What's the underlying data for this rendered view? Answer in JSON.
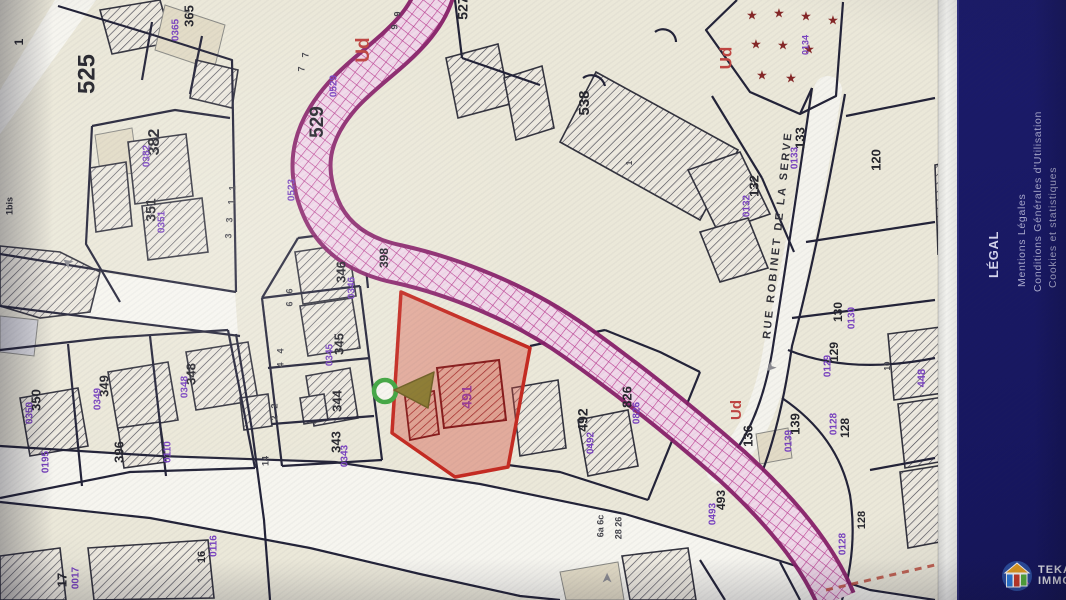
{
  "sidebar": {
    "heading": "LÉGAL",
    "links": [
      {
        "label": "Mentions Légales"
      },
      {
        "label": "Conditions Générales d'Utilisation"
      },
      {
        "label": "Cookies et statistiques"
      }
    ]
  },
  "watermark": {
    "line1": "TEKA",
    "line2": "IMMO"
  },
  "map": {
    "street_name": "RUE ROBINET DE LA SERVE",
    "selected_parcel_number": "491",
    "zone_code": "Ud",
    "star_glyph": "★",
    "arrow_glyph": "➤",
    "colors": {
      "background": "#ebe8d8",
      "road": "#f6f5ef",
      "parcel_line": "#23233a",
      "black_label": "#26262e",
      "purple_label": "#7b3fc8",
      "zone_label_red": "#c8433f",
      "selected_fill": "rgba(224,68,52,0.38)",
      "selected_stroke": "#d0281e",
      "band_magenta": "#8e1d6e",
      "star_red": "#8b2525",
      "sidebar_bg": "#191965"
    },
    "labels": [
      {
        "t": "525",
        "x": 88,
        "y": 74,
        "s": 24,
        "c": "k"
      },
      {
        "t": "1",
        "x": 20,
        "y": 42,
        "s": 12,
        "c": "k"
      },
      {
        "t": "365",
        "x": 190,
        "y": 16,
        "s": 13,
        "c": "k"
      },
      {
        "t": "0365",
        "x": 176,
        "y": 30,
        "s": 10,
        "c": "p"
      },
      {
        "t": "382",
        "x": 155,
        "y": 142,
        "s": 16,
        "c": "k"
      },
      {
        "t": "0382",
        "x": 147,
        "y": 156,
        "s": 10,
        "c": "p"
      },
      {
        "t": "351",
        "x": 152,
        "y": 210,
        "s": 14,
        "c": "k"
      },
      {
        "t": "0351",
        "x": 162,
        "y": 222,
        "s": 10,
        "c": "p"
      },
      {
        "t": "1bis",
        "x": 10,
        "y": 206,
        "s": 9,
        "c": "k"
      },
      {
        "t": "1",
        "x": 233,
        "y": 188,
        "s": 9,
        "c": "g"
      },
      {
        "t": "1",
        "x": 232,
        "y": 202,
        "s": 9,
        "c": "g"
      },
      {
        "t": "3",
        "x": 230,
        "y": 220,
        "s": 9,
        "c": "g"
      },
      {
        "t": "3",
        "x": 229,
        "y": 236,
        "s": 9,
        "c": "g"
      },
      {
        "t": "527",
        "x": 464,
        "y": 8,
        "s": 14,
        "c": "k"
      },
      {
        "t": "529",
        "x": 318,
        "y": 122,
        "s": 19,
        "c": "k"
      },
      {
        "t": "0529",
        "x": 334,
        "y": 86,
        "s": 10,
        "c": "p"
      },
      {
        "t": "Ud",
        "x": 364,
        "y": 50,
        "s": 19,
        "c": "r"
      },
      {
        "t": "7",
        "x": 306,
        "y": 55,
        "s": 9,
        "c": "g"
      },
      {
        "t": "7",
        "x": 302,
        "y": 69,
        "s": 9,
        "c": "g"
      },
      {
        "t": "9",
        "x": 398,
        "y": 14,
        "s": 9,
        "c": "g"
      },
      {
        "t": "9",
        "x": 395,
        "y": 27,
        "s": 9,
        "c": "g"
      },
      {
        "t": "398",
        "x": 385,
        "y": 258,
        "s": 12,
        "c": "k"
      },
      {
        "t": "0523",
        "x": 292,
        "y": 190,
        "s": 10,
        "c": "p"
      },
      {
        "t": "346",
        "x": 342,
        "y": 272,
        "s": 13,
        "c": "k"
      },
      {
        "t": "0346",
        "x": 352,
        "y": 288,
        "s": 10,
        "c": "p"
      },
      {
        "t": "538",
        "x": 585,
        "y": 103,
        "s": 15,
        "c": "k"
      },
      {
        "t": "1",
        "x": 630,
        "y": 163,
        "s": 8,
        "c": "g"
      },
      {
        "t": "Ud",
        "x": 727,
        "y": 58,
        "s": 17,
        "c": "r"
      },
      {
        "t": "0134",
        "x": 806,
        "y": 45,
        "s": 9,
        "c": "p"
      },
      {
        "t": "133",
        "x": 801,
        "y": 138,
        "s": 13,
        "c": "k"
      },
      {
        "t": "0133",
        "x": 795,
        "y": 158,
        "s": 10,
        "c": "p"
      },
      {
        "t": "132",
        "x": 755,
        "y": 186,
        "s": 13,
        "c": "k"
      },
      {
        "t": "0132",
        "x": 747,
        "y": 206,
        "s": 10,
        "c": "p"
      },
      {
        "t": "120",
        "x": 877,
        "y": 160,
        "s": 13,
        "c": "k"
      },
      {
        "t": "350",
        "x": 37,
        "y": 400,
        "s": 13,
        "c": "k"
      },
      {
        "t": "0350",
        "x": 30,
        "y": 413,
        "s": 10,
        "c": "p"
      },
      {
        "t": "349",
        "x": 105,
        "y": 386,
        "s": 13,
        "c": "k"
      },
      {
        "t": "0349",
        "x": 98,
        "y": 399,
        "s": 10,
        "c": "p"
      },
      {
        "t": "348",
        "x": 192,
        "y": 374,
        "s": 13,
        "c": "k"
      },
      {
        "t": "0348",
        "x": 185,
        "y": 387,
        "s": 10,
        "c": "p"
      },
      {
        "t": "345",
        "x": 340,
        "y": 344,
        "s": 13,
        "c": "k"
      },
      {
        "t": "0345",
        "x": 330,
        "y": 355,
        "s": 10,
        "c": "p"
      },
      {
        "t": "344",
        "x": 338,
        "y": 401,
        "s": 13,
        "c": "k"
      },
      {
        "t": "343",
        "x": 337,
        "y": 442,
        "s": 13,
        "c": "k"
      },
      {
        "t": "0343",
        "x": 345,
        "y": 456,
        "s": 10,
        "c": "p"
      },
      {
        "t": "396",
        "x": 120,
        "y": 452,
        "s": 13,
        "c": "k"
      },
      {
        "t": "0110",
        "x": 168,
        "y": 452,
        "s": 10,
        "c": "p"
      },
      {
        "t": "0195",
        "x": 46,
        "y": 462,
        "s": 10,
        "c": "p"
      },
      {
        "t": "6",
        "x": 290,
        "y": 291,
        "s": 9,
        "c": "g"
      },
      {
        "t": "6",
        "x": 290,
        "y": 304,
        "s": 9,
        "c": "g"
      },
      {
        "t": "4",
        "x": 281,
        "y": 351,
        "s": 9,
        "c": "g"
      },
      {
        "t": "4",
        "x": 281,
        "y": 365,
        "s": 9,
        "c": "g"
      },
      {
        "t": "2",
        "x": 275,
        "y": 406,
        "s": 9,
        "c": "g"
      },
      {
        "t": "2",
        "x": 275,
        "y": 418,
        "s": 9,
        "c": "g"
      },
      {
        "t": "14",
        "x": 266,
        "y": 461,
        "s": 9,
        "c": "g"
      },
      {
        "t": "17",
        "x": 63,
        "y": 580,
        "s": 13,
        "c": "k"
      },
      {
        "t": "0017",
        "x": 76,
        "y": 578,
        "s": 10,
        "c": "p"
      },
      {
        "t": "16",
        "x": 202,
        "y": 557,
        "s": 11,
        "c": "k"
      },
      {
        "t": "0116",
        "x": 214,
        "y": 546,
        "s": 10,
        "c": "p"
      },
      {
        "t": "492",
        "x": 584,
        "y": 420,
        "s": 14,
        "c": "k"
      },
      {
        "t": "0492",
        "x": 591,
        "y": 443,
        "s": 10,
        "c": "p"
      },
      {
        "t": "826",
        "x": 628,
        "y": 397,
        "s": 13,
        "c": "k"
      },
      {
        "t": "0826",
        "x": 637,
        "y": 413,
        "s": 10,
        "c": "p"
      },
      {
        "t": "6a 6c",
        "x": 601,
        "y": 526,
        "s": 9,
        "c": "g"
      },
      {
        "t": "28 26",
        "x": 619,
        "y": 528,
        "s": 9,
        "c": "g"
      },
      {
        "t": "493",
        "x": 722,
        "y": 500,
        "s": 12,
        "c": "k"
      },
      {
        "t": "0493",
        "x": 713,
        "y": 514,
        "s": 10,
        "c": "p"
      },
      {
        "t": "Ud",
        "x": 737,
        "y": 410,
        "s": 15,
        "c": "r"
      },
      {
        "t": "136",
        "x": 749,
        "y": 436,
        "s": 13,
        "c": "k"
      },
      {
        "t": "139",
        "x": 796,
        "y": 424,
        "s": 13,
        "c": "k"
      },
      {
        "t": "0139",
        "x": 789,
        "y": 441,
        "s": 10,
        "c": "p"
      },
      {
        "t": "130",
        "x": 839,
        "y": 312,
        "s": 12,
        "c": "k"
      },
      {
        "t": "0130",
        "x": 852,
        "y": 318,
        "s": 10,
        "c": "p"
      },
      {
        "t": "129",
        "x": 835,
        "y": 352,
        "s": 12,
        "c": "k"
      },
      {
        "t": "0129",
        "x": 828,
        "y": 366,
        "s": 10,
        "c": "p"
      },
      {
        "t": "10",
        "x": 888,
        "y": 366,
        "s": 8,
        "c": "g"
      },
      {
        "t": "448",
        "x": 922,
        "y": 378,
        "s": 11,
        "c": "p"
      },
      {
        "t": "128",
        "x": 846,
        "y": 428,
        "s": 12,
        "c": "k"
      },
      {
        "t": "0128",
        "x": 834,
        "y": 424,
        "s": 10,
        "c": "p"
      },
      {
        "t": "128",
        "x": 862,
        "y": 520,
        "s": 11,
        "c": "k"
      },
      {
        "t": "0128",
        "x": 843,
        "y": 544,
        "s": 10,
        "c": "p"
      },
      {
        "t": "491",
        "x": 468,
        "y": 397,
        "s": 14,
        "c": "m"
      }
    ],
    "street_label": {
      "x": 778,
      "y": 235,
      "s": 11,
      "rot": -84
    },
    "stars": [
      [
        752,
        16
      ],
      [
        779,
        14
      ],
      [
        806,
        17
      ],
      [
        833,
        21
      ],
      [
        756,
        45
      ],
      [
        783,
        46
      ],
      [
        809,
        50
      ],
      [
        762,
        76
      ],
      [
        791,
        79
      ]
    ],
    "arrows": [
      {
        "x": 770,
        "y": 367,
        "a": 135
      },
      {
        "x": 608,
        "y": 578,
        "a": -90
      },
      {
        "x": 68,
        "y": 262,
        "a": 215
      }
    ]
  }
}
